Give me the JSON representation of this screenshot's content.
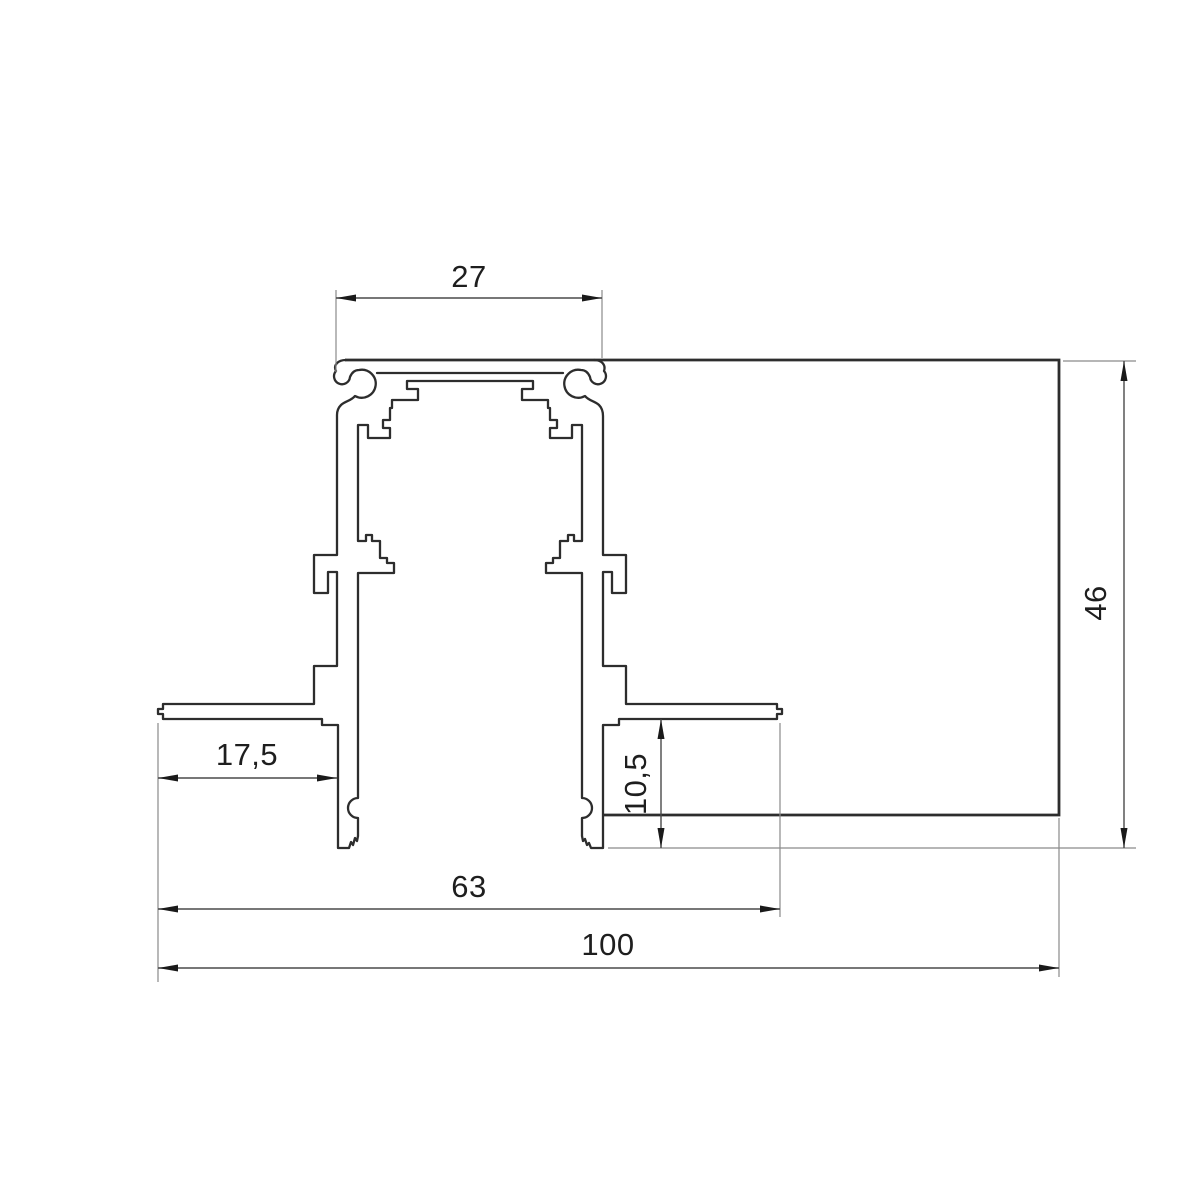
{
  "drawing": {
    "type": "technical-cross-section-profile",
    "background": "#ffffff",
    "line_color": "#2d2d2d",
    "dim_line_color": "#4a4a4a",
    "dimensions": {
      "track_width": "27",
      "overall_height": "46",
      "flange_offset": "17,5",
      "recess_depth": "10,5",
      "opening_width": "63",
      "overall_width": "100"
    }
  }
}
